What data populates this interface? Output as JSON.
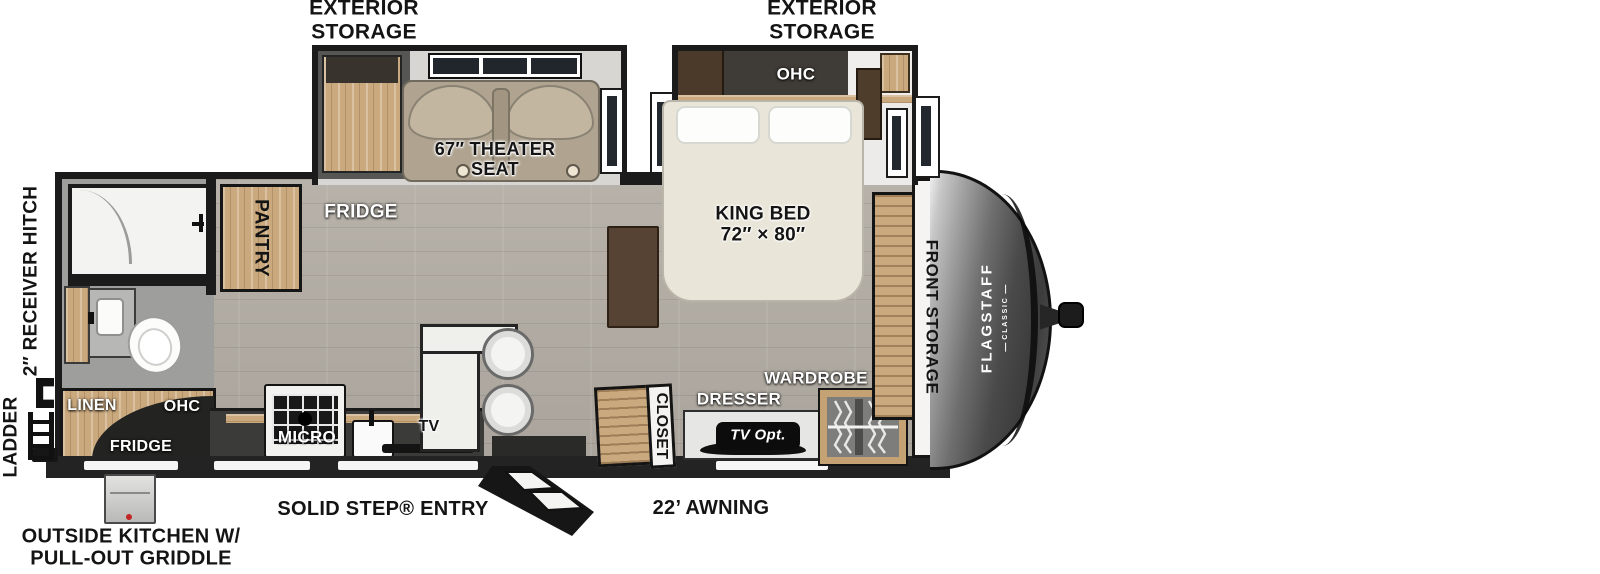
{
  "colors": {
    "wall": "#1b1b1b",
    "floor_wood": "#b3ada4",
    "bath_floor": "#9e9e9c",
    "cabinet_wood": "#cba97e",
    "theater_seat": "#b0a491",
    "bed": "#e9e5d8",
    "counter": "#3b3b39",
    "front_cap": "#4a4a4a",
    "badge": "#0c0c0c"
  },
  "exterior": {
    "storage_left": [
      "EXTERIOR",
      "STORAGE"
    ],
    "storage_right": [
      "EXTERIOR",
      "STORAGE"
    ],
    "receiver_hitch": "2″ RECEIVER HITCH",
    "ladder": "LADDER",
    "outside_kitchen": [
      "OUTSIDE KITCHEN W/",
      "PULL-OUT GRIDDLE"
    ],
    "solid_step_entry": "SOLID STEP® ENTRY",
    "awning": "22’ AWNING"
  },
  "living": {
    "theater_seat": [
      "67″ THEATER",
      "SEAT"
    ],
    "fridge": "FRIDGE",
    "pantry": "PANTRY"
  },
  "kitchen": {
    "micro": "MICRO",
    "tv": "TV",
    "linen": "LINEN",
    "ohc": "OHC",
    "fridge": "FRIDGE"
  },
  "bedroom": {
    "ohc": "OHC",
    "king_bed": [
      "KING BED",
      "72″ × 80″"
    ],
    "closet": "CLOSET",
    "dresser": "DRESSER",
    "tv_opt": "TV Opt.",
    "wardrobe": "WARDROBE",
    "front_storage": "FRONT STORAGE"
  },
  "brand": {
    "name": "FLAGSTAFF",
    "series": "CLASSIC"
  }
}
